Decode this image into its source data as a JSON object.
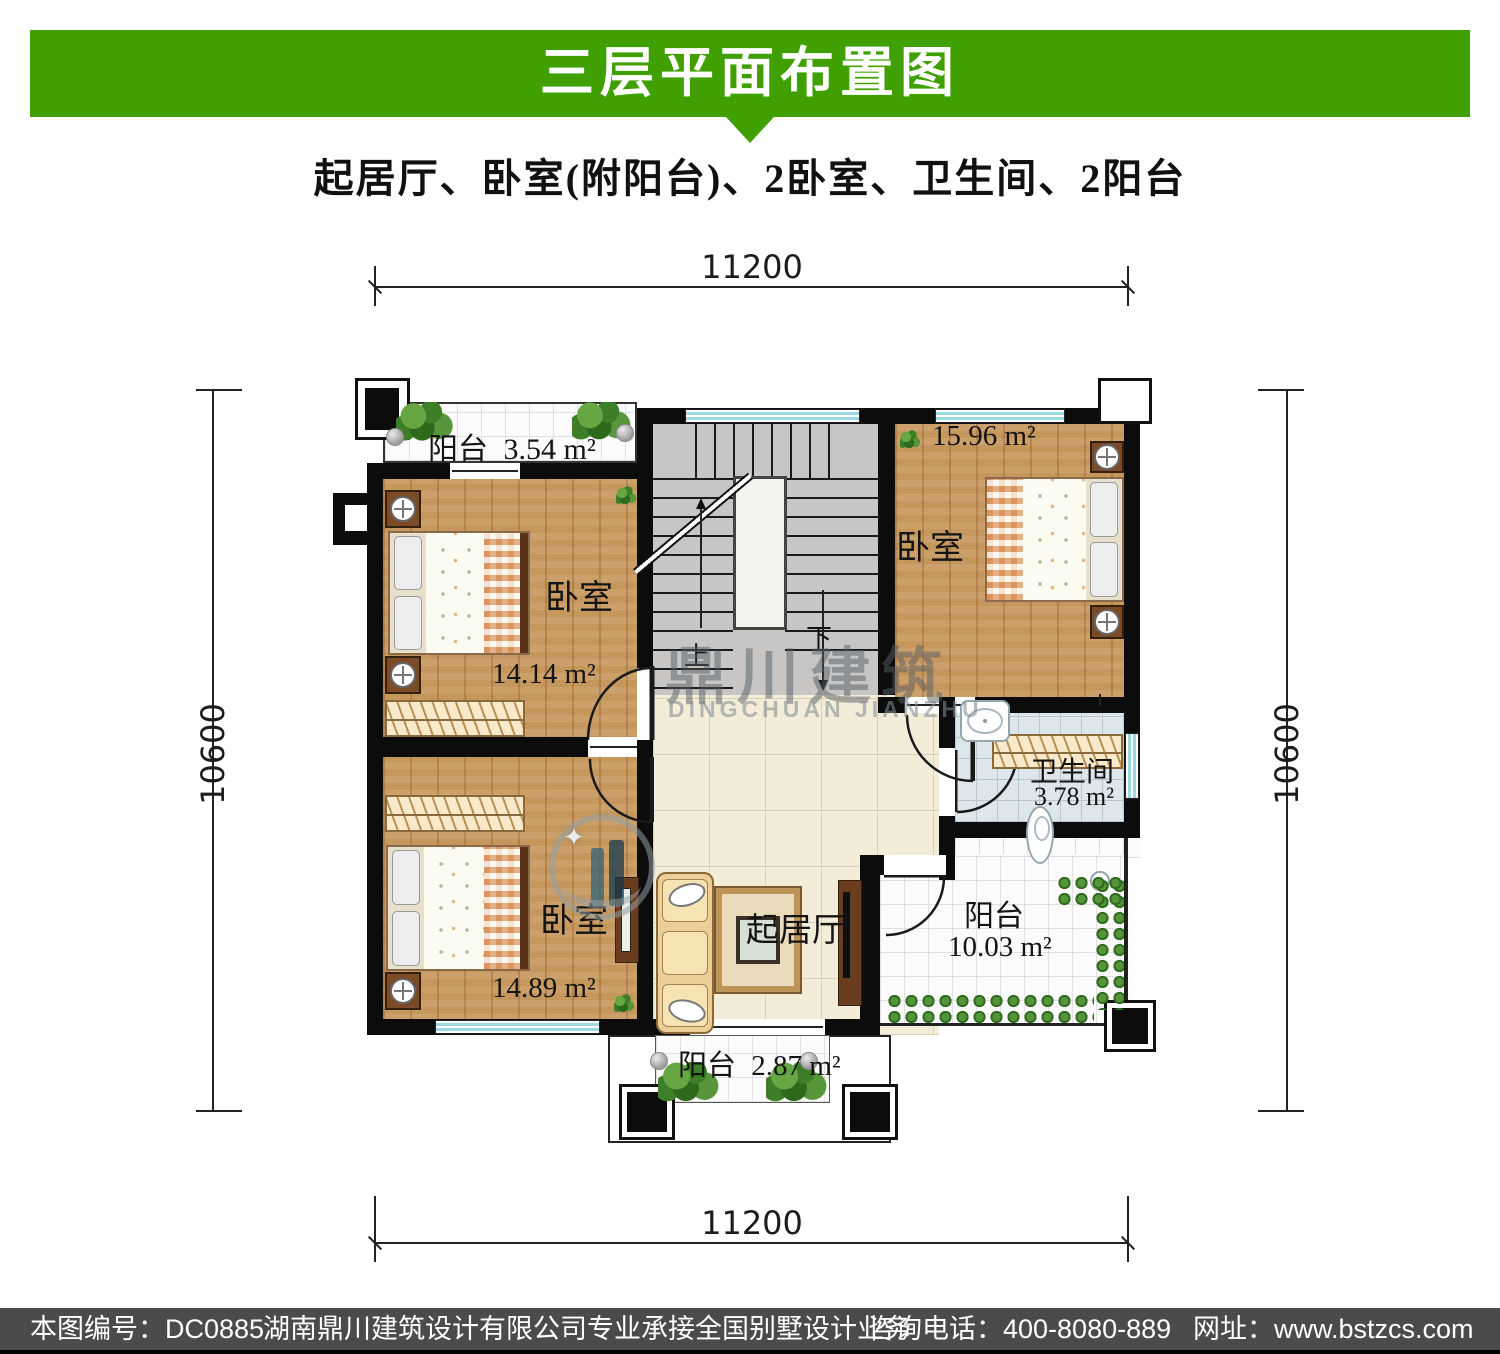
{
  "header": {
    "title": "三层平面布置图",
    "subtitle": "起居厅、卧室(附阳台)、2卧室、卫生间、2阳台"
  },
  "dimensions": {
    "top": "11200",
    "bottom": "11200",
    "left": "10600",
    "right": "10600"
  },
  "rooms": {
    "balcony_top": {
      "label": "阳台",
      "area": "3.54 m²"
    },
    "bedroom_a": {
      "label": "卧室",
      "area": "14.14 m²"
    },
    "bedroom_b": {
      "label": "卧室",
      "area": "14.89 m²"
    },
    "bedroom_c": {
      "label": "卧室",
      "area": "15.96 m²"
    },
    "bathroom": {
      "label": "卫生间",
      "area": "3.78 m²"
    },
    "living": {
      "label": "起居厅"
    },
    "balcony_right": {
      "label": "阳台",
      "area": "10.03 m²"
    },
    "balcony_bottom": {
      "label": "阳台",
      "area": "2.87 m²"
    }
  },
  "stairs": {
    "up": "上",
    "down": "下"
  },
  "watermark": {
    "cn": "鼎川建筑",
    "en": "DINGCHUAN JIANZHU"
  },
  "footer": {
    "code": "本图编号：DC0885",
    "company": "湖南鼎川建筑设计有限公司专业承接全国别墅设计业务",
    "phone": "咨询电话：400-8080-889",
    "website": "网址：www.bstzcs.com"
  },
  "colors": {
    "banner_green": "#40a001",
    "footer_gray": "#4b4b4b",
    "wall_black": "#0c0c0c",
    "wood_floor": "#c6975c",
    "window_cyan": "#9bd8e0"
  }
}
